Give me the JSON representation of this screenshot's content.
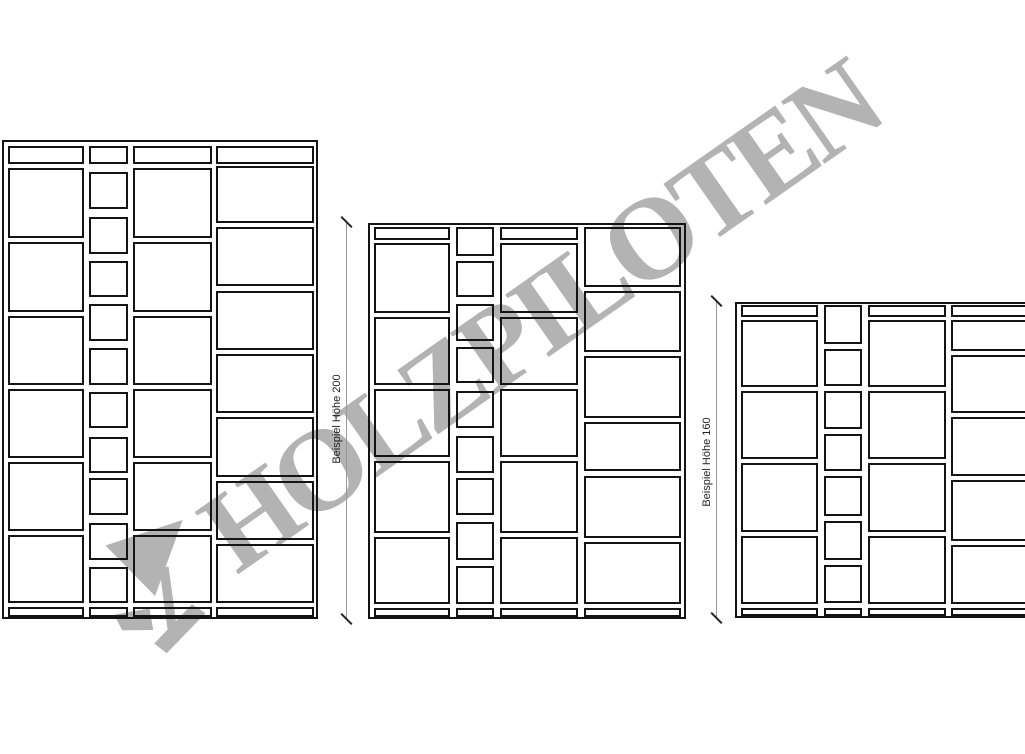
{
  "watermark": {
    "text": "HOLZPILOTEN",
    "logo": "holzpiloten-wing-logo",
    "color": "#b3b3b3",
    "angle_deg": -35
  },
  "drawing": {
    "background": "#ffffff",
    "line_color": "#141414",
    "dim_line_color": "#9a9a9a",
    "dim_tick_color": "#222222",
    "label_color": "#1f1f1f"
  },
  "dimension_lines": [
    {
      "label": "Beispiel Höhe 200",
      "x": 346,
      "y1": 222,
      "y2": 619,
      "label_cx": 337,
      "label_cy": 419
    },
    {
      "label": "Beispiel Höhe 160",
      "x": 716,
      "y1": 301,
      "y2": 618,
      "label_cx": 707,
      "label_cy": 462
    }
  ],
  "shelves": [
    {
      "id": "shelf-left",
      "frame": {
        "x": 2,
        "y": 140,
        "w": 316,
        "h": 479
      },
      "columns": [
        {
          "x": 8,
          "w": 76,
          "cells": [
            [
              146,
              18
            ],
            [
              168,
              70
            ],
            [
              242,
              70
            ],
            [
              316,
              69
            ],
            [
              389,
              69
            ],
            [
              462,
              69
            ],
            [
              535,
              68
            ],
            [
              607,
              10
            ]
          ]
        },
        {
          "x": 89,
          "w": 39,
          "cells": [
            [
              146,
              18
            ],
            [
              172,
              37
            ],
            [
              217,
              37
            ],
            [
              261,
              36
            ],
            [
              304,
              37
            ],
            [
              348,
              37
            ],
            [
              392,
              36
            ],
            [
              437,
              36
            ],
            [
              478,
              37
            ],
            [
              523,
              37
            ],
            [
              567,
              36
            ],
            [
              607,
              10
            ]
          ]
        },
        {
          "x": 133,
          "w": 79,
          "cells": [
            [
              146,
              18
            ],
            [
              168,
              70
            ],
            [
              242,
              70
            ],
            [
              316,
              69
            ],
            [
              389,
              69
            ],
            [
              462,
              69
            ],
            [
              535,
              68
            ],
            [
              607,
              10
            ]
          ]
        },
        {
          "x": 216,
          "w": 98,
          "cells": [
            [
              146,
              18
            ],
            [
              166,
              57
            ],
            [
              227,
              59
            ],
            [
              291,
              59
            ],
            [
              354,
              59
            ],
            [
              417,
              60
            ],
            [
              481,
              59
            ],
            [
              544,
              59
            ],
            [
              607,
              10
            ]
          ]
        }
      ]
    },
    {
      "id": "shelf-middle",
      "frame": {
        "x": 368,
        "y": 223,
        "w": 318,
        "h": 396
      },
      "columns": [
        {
          "x": 374,
          "w": 76,
          "cells": [
            [
              227,
              13
            ],
            [
              243,
              70
            ],
            [
              317,
              68
            ],
            [
              389,
              68
            ],
            [
              461,
              72
            ],
            [
              537,
              67
            ],
            [
              608,
              9
            ]
          ]
        },
        {
          "x": 456,
          "w": 38,
          "cells": [
            [
              227,
              29
            ],
            [
              261,
              36
            ],
            [
              304,
              37
            ],
            [
              347,
              36
            ],
            [
              391,
              37
            ],
            [
              436,
              37
            ],
            [
              478,
              37
            ],
            [
              522,
              38
            ],
            [
              566,
              38
            ],
            [
              608,
              9
            ]
          ]
        },
        {
          "x": 500,
          "w": 78,
          "cells": [
            [
              227,
              13
            ],
            [
              243,
              70
            ],
            [
              317,
              68
            ],
            [
              389,
              68
            ],
            [
              461,
              72
            ],
            [
              537,
              67
            ],
            [
              608,
              9
            ]
          ]
        },
        {
          "x": 584,
          "w": 97,
          "cells": [
            [
              227,
              60
            ],
            [
              291,
              61
            ],
            [
              356,
              62
            ],
            [
              422,
              49
            ],
            [
              476,
              62
            ],
            [
              542,
              62
            ],
            [
              608,
              9
            ]
          ]
        }
      ]
    },
    {
      "id": "shelf-right",
      "frame": {
        "x": 735,
        "y": 302,
        "w": 302,
        "h": 316
      },
      "columns": [
        {
          "x": 741,
          "w": 77,
          "cells": [
            [
              305,
              12
            ],
            [
              320,
              67
            ],
            [
              391,
              68
            ],
            [
              463,
              69
            ],
            [
              536,
              68
            ],
            [
              608,
              8
            ]
          ]
        },
        {
          "x": 824,
          "w": 38,
          "cells": [
            [
              305,
              39
            ],
            [
              349,
              37
            ],
            [
              391,
              38
            ],
            [
              434,
              37
            ],
            [
              476,
              40
            ],
            [
              521,
              39
            ],
            [
              565,
              38
            ],
            [
              608,
              8
            ]
          ]
        },
        {
          "x": 868,
          "w": 78,
          "cells": [
            [
              305,
              12
            ],
            [
              320,
              67
            ],
            [
              391,
              68
            ],
            [
              463,
              69
            ],
            [
              536,
              68
            ],
            [
              608,
              8
            ]
          ]
        },
        {
          "x": 951,
          "w": 86,
          "cells": [
            [
              305,
              12
            ],
            [
              320,
              31
            ],
            [
              355,
              58
            ],
            [
              417,
              59
            ],
            [
              480,
              61
            ],
            [
              545,
              59
            ],
            [
              608,
              8
            ]
          ]
        }
      ]
    }
  ]
}
